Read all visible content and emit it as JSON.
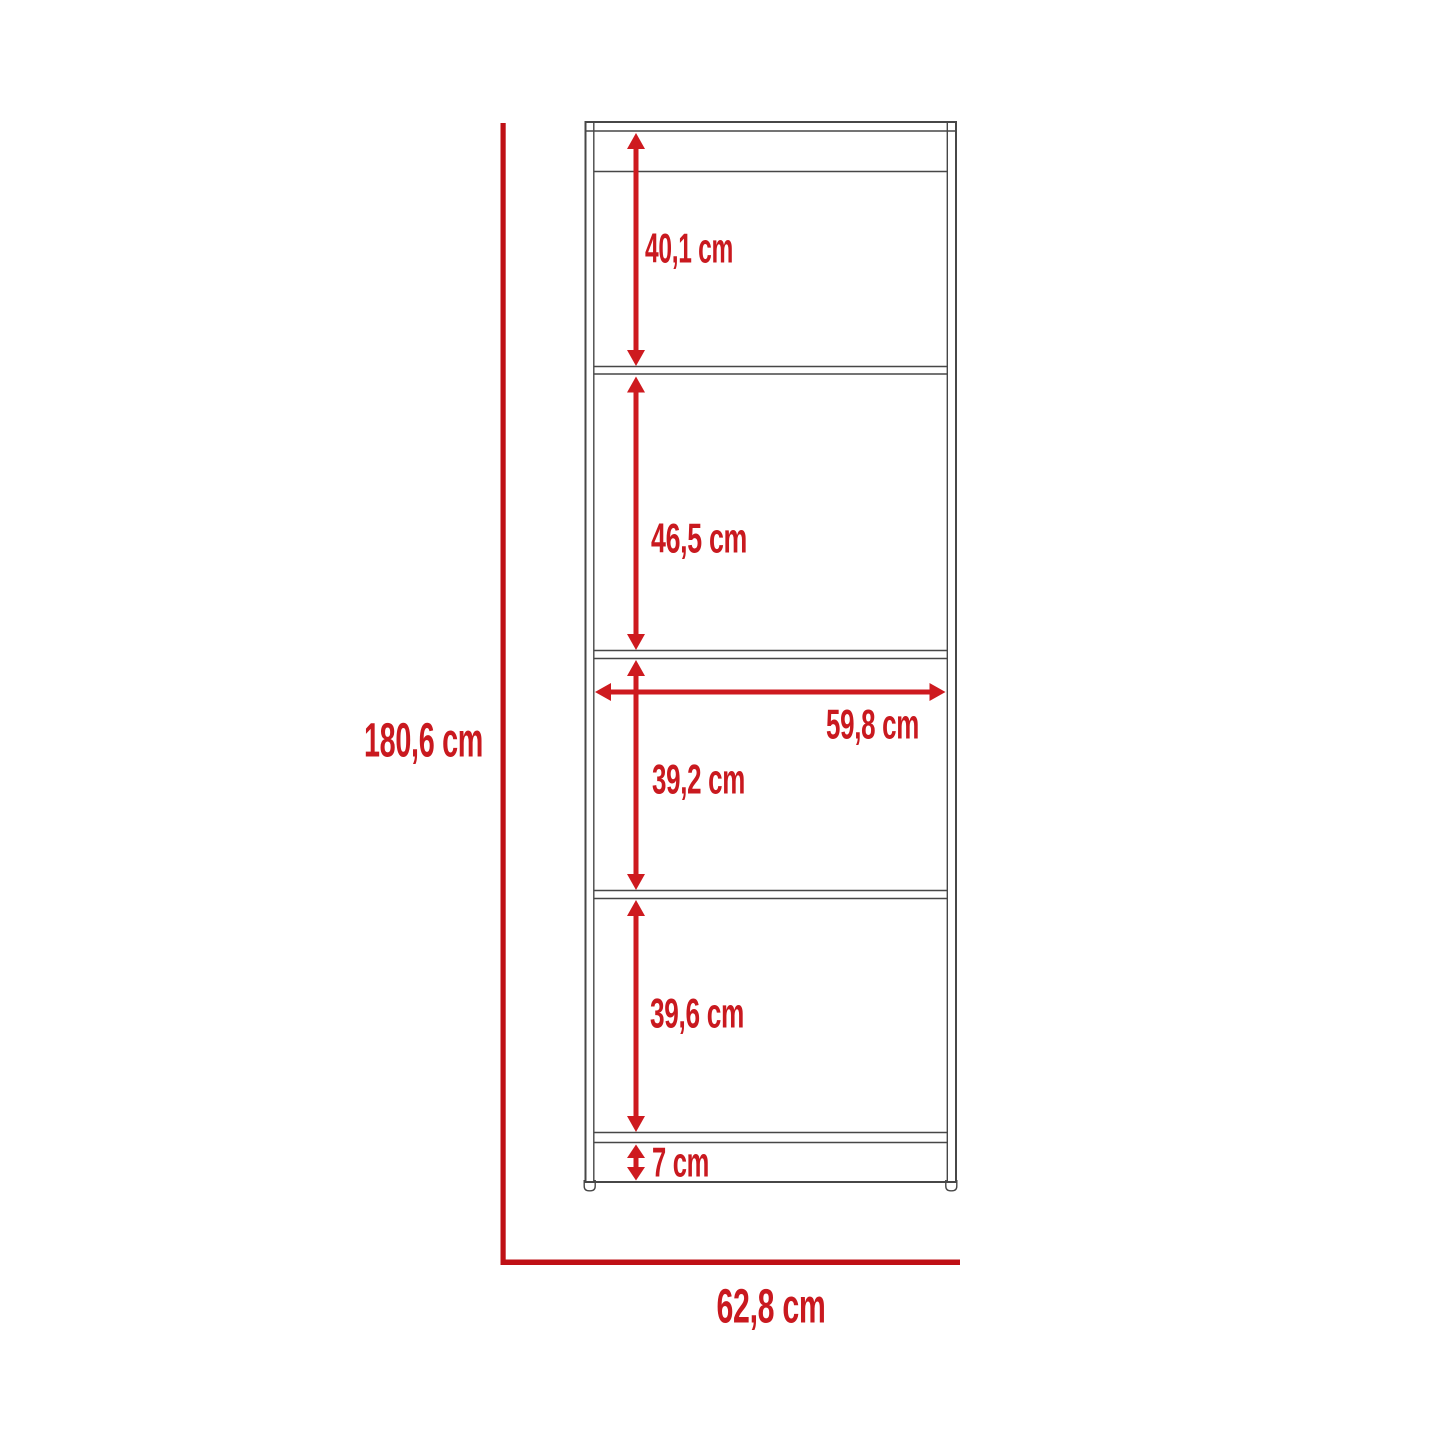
{
  "diagram": {
    "type": "furniture-dimension-drawing",
    "subject": "tall 4-shelf bookcase front elevation",
    "unit": "cm",
    "measurements": {
      "overall_height": {
        "label": "180,6 cm",
        "value": 180.6
      },
      "overall_width": {
        "label": "62,8 cm",
        "value": 62.8
      },
      "section_1_height": {
        "label": "40,1 cm",
        "value": 40.1
      },
      "section_2_height": {
        "label": "46,5 cm",
        "value": 46.5
      },
      "inner_width": {
        "label": "59,8 cm",
        "value": 59.8
      },
      "section_3_height": {
        "label": "39,2 cm",
        "value": 39.2
      },
      "section_4_height": {
        "label": "39,6 cm",
        "value": 39.6
      },
      "base_height": {
        "label": "7 cm",
        "value": 7
      }
    },
    "colors": {
      "dimension_red": "#c9191f",
      "extent_line_red": "#bf1015",
      "outline_gray": "#474747",
      "background": "#ffffff"
    }
  }
}
